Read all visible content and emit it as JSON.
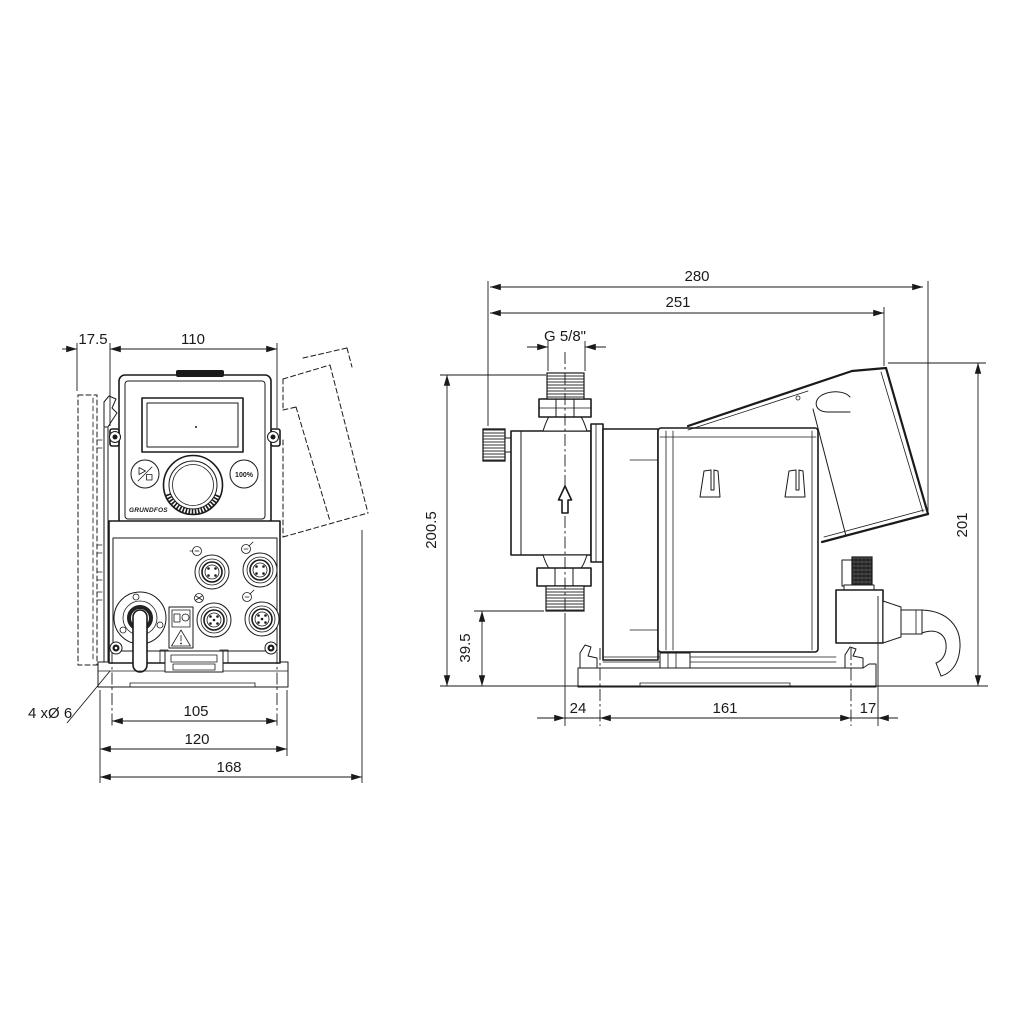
{
  "drawing": {
    "kind": "technical-dimensional-drawing",
    "subject": "dosing pump, front and side views",
    "line_color": "#1a1a1a",
    "background": "#ffffff"
  },
  "front_view": {
    "dims": {
      "wall_plate_offset": "17.5",
      "panel_width": "110",
      "mounting_hole_spacing": "105",
      "base_width": "120",
      "overall_width": "168"
    },
    "mounting_holes_note": "4 xØ 6",
    "control_panel": {
      "brand": "GRUNDFOS",
      "button_100pct": "100%"
    }
  },
  "side_view": {
    "dims": {
      "overall_depth": "280",
      "depth_to_bracket": "251",
      "connection_thread": "G 5/8\"",
      "height_overall": "200.5",
      "connection_height": "39.5",
      "bracket_height": "201",
      "base_front_offset": "24",
      "base_hole_spacing": "161",
      "base_rear_offset": "17"
    }
  }
}
